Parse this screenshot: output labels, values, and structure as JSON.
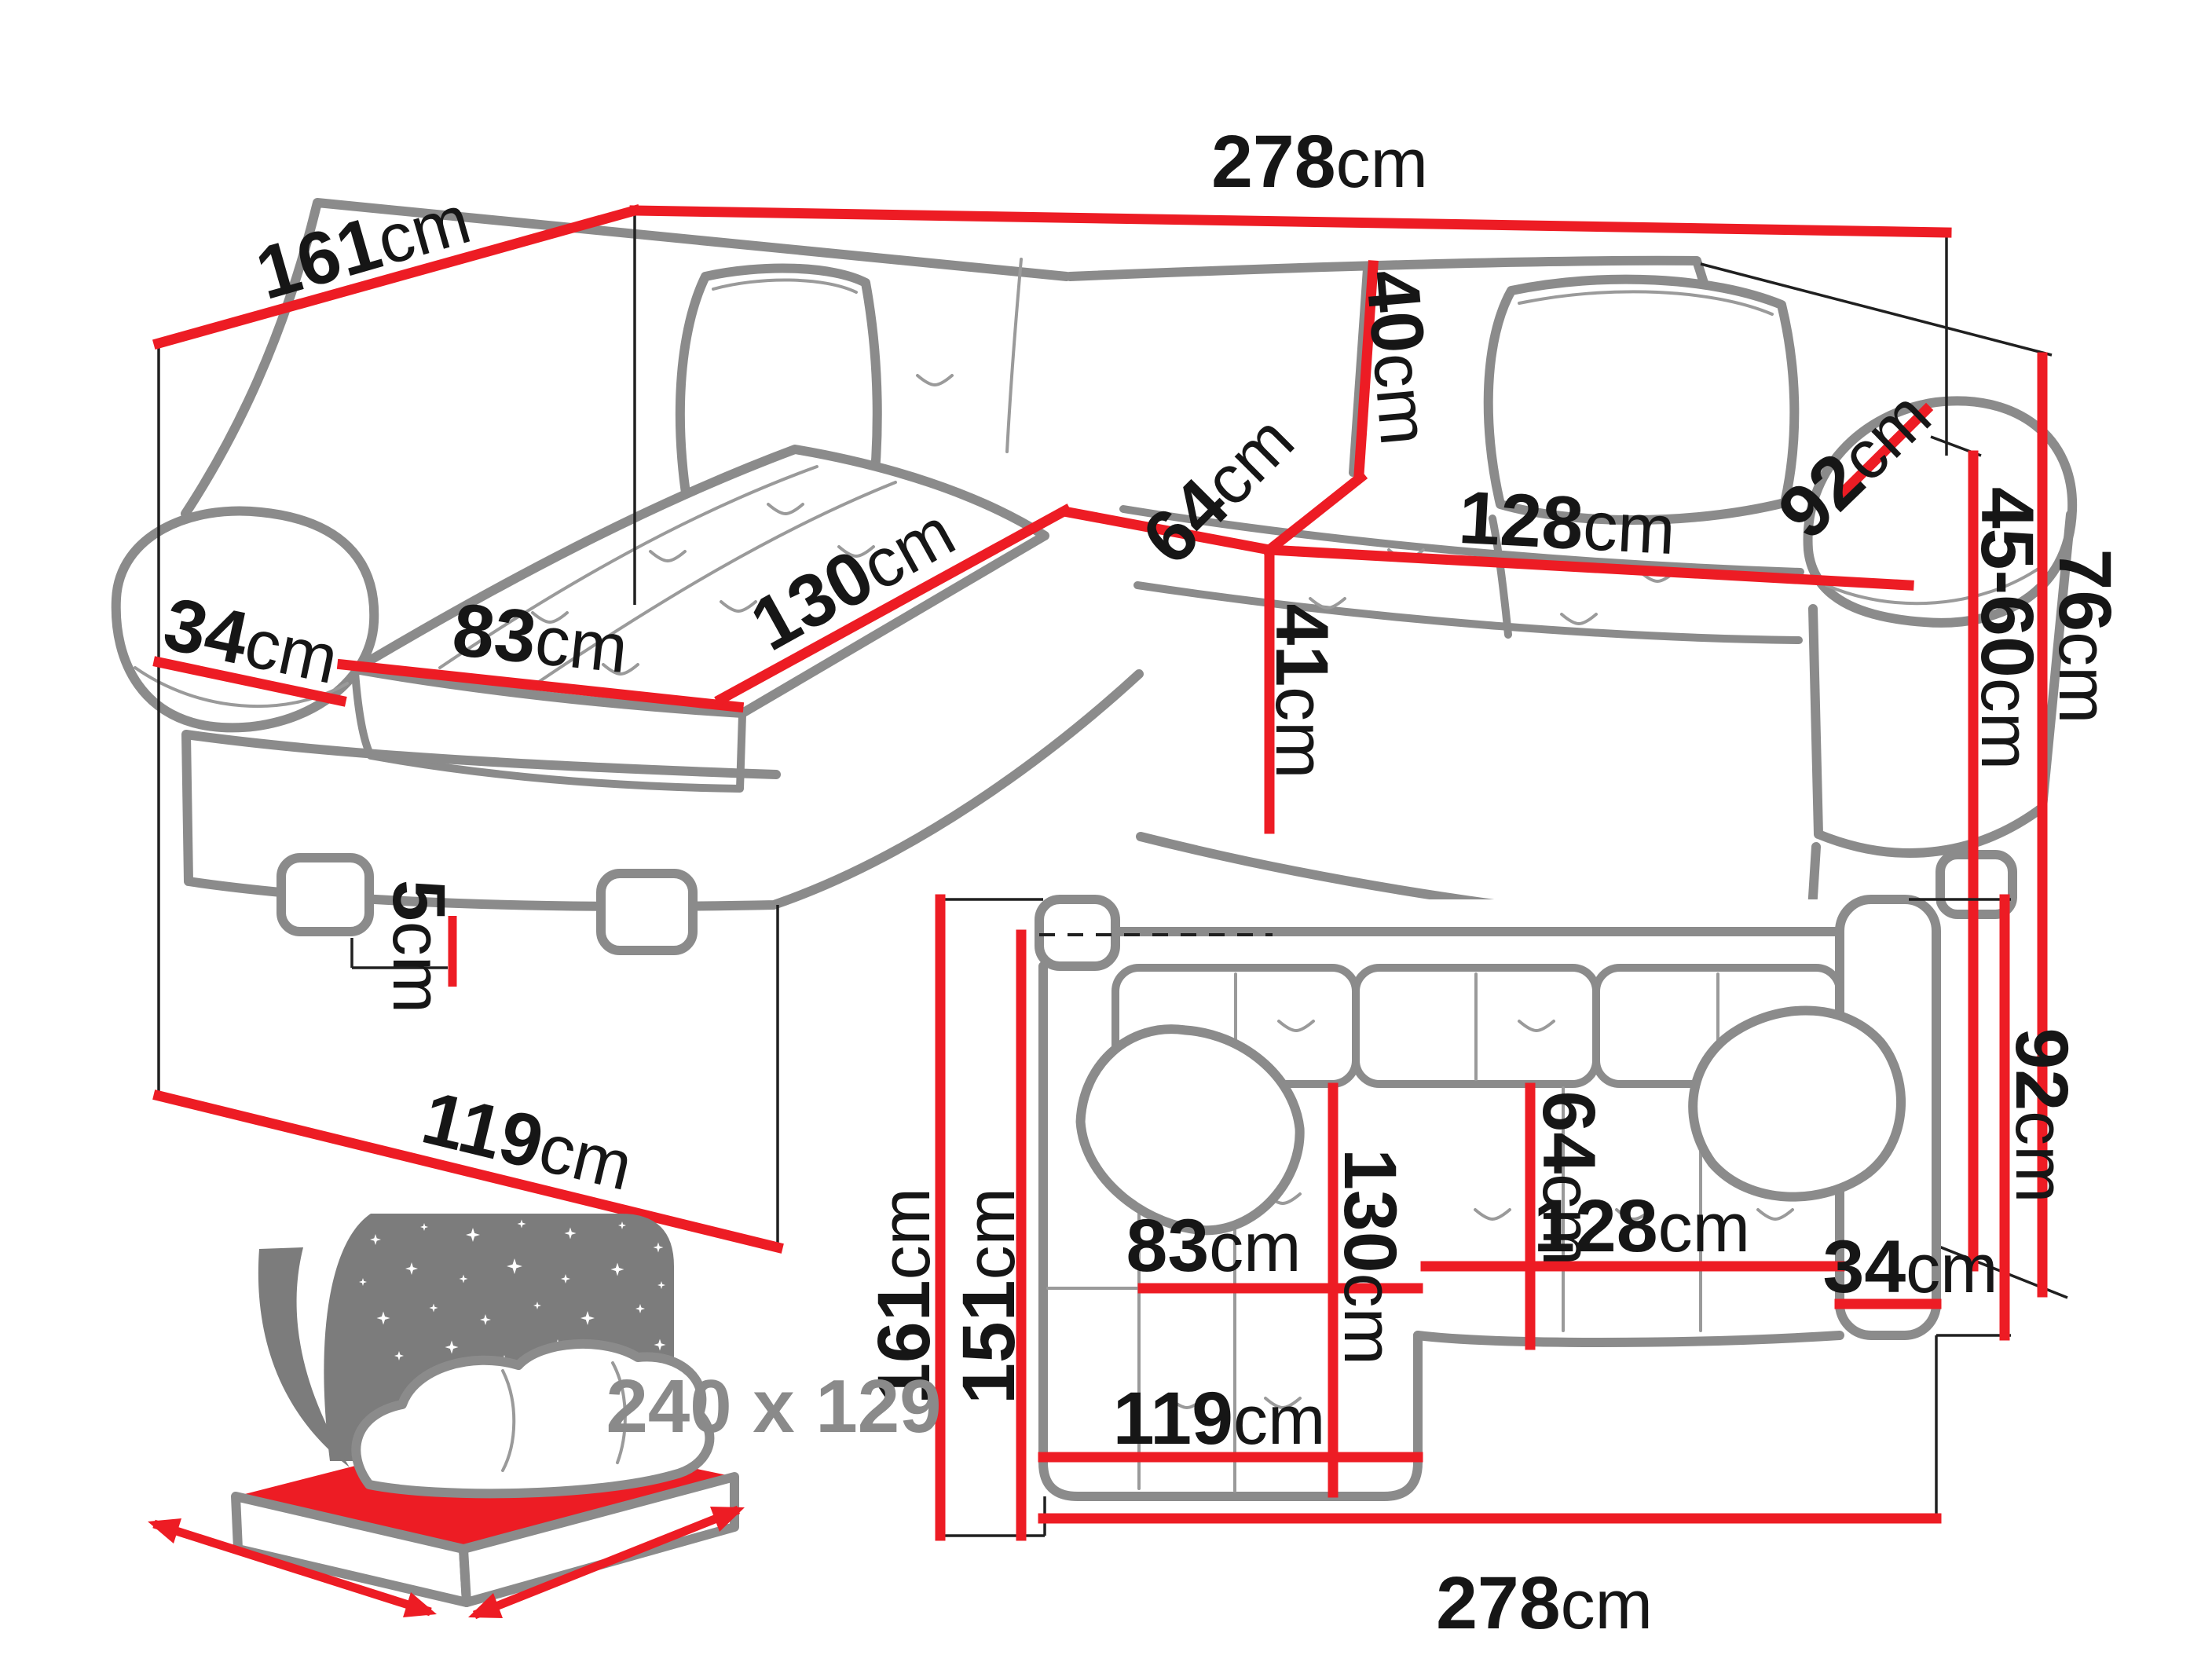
{
  "colors": {
    "dimension_red": "#ed1c24",
    "outline_gray": "#8b8b8b",
    "label_black": "#161616",
    "muted_gray": "#8a8a8a"
  },
  "perspective_view": {
    "dimensions": {
      "total_width": {
        "num": "278",
        "unit": "cm"
      },
      "total_depth": {
        "num": "161",
        "unit": "cm"
      },
      "backrest_height": {
        "num": "40",
        "unit": "cm"
      },
      "seat_depth": {
        "num": "64",
        "unit": "cm"
      },
      "seat_width": {
        "num": "128",
        "unit": "cm"
      },
      "armrest_length": {
        "num": "92",
        "unit": "cm"
      },
      "total_height": {
        "num": "76",
        "unit": "cm"
      },
      "headrest_height": {
        "num": "45-60",
        "unit": "cm"
      },
      "armrest_width": {
        "num": "34",
        "unit": "cm"
      },
      "chaise_seat_width": {
        "num": "83",
        "unit": "cm"
      },
      "chaise_length": {
        "num": "130",
        "unit": "cm"
      },
      "seat_height": {
        "num": "41",
        "unit": "cm"
      },
      "leg_height": {
        "num": "5",
        "unit": "cm"
      },
      "chaise_depth": {
        "num": "119",
        "unit": "cm"
      }
    }
  },
  "plan_view": {
    "dimensions": {
      "total_depth": {
        "num": "161",
        "unit": "cm"
      },
      "inner_depth": {
        "num": "151",
        "unit": "cm"
      },
      "chaise_length": {
        "num": "130",
        "unit": "cm"
      },
      "seat_depth": {
        "num": "64",
        "unit": "cm"
      },
      "seat_width": {
        "num": "128",
        "unit": "cm"
      },
      "armrest_width": {
        "num": "34",
        "unit": "cm"
      },
      "armrest_length": {
        "num": "92",
        "unit": "cm"
      },
      "chaise_seat_width": {
        "num": "83",
        "unit": "cm"
      },
      "chaise_depth": {
        "num": "119",
        "unit": "cm"
      },
      "total_width": {
        "num": "278",
        "unit": "cm"
      }
    }
  },
  "sleeping_area": {
    "size_label": "240 x 129"
  }
}
